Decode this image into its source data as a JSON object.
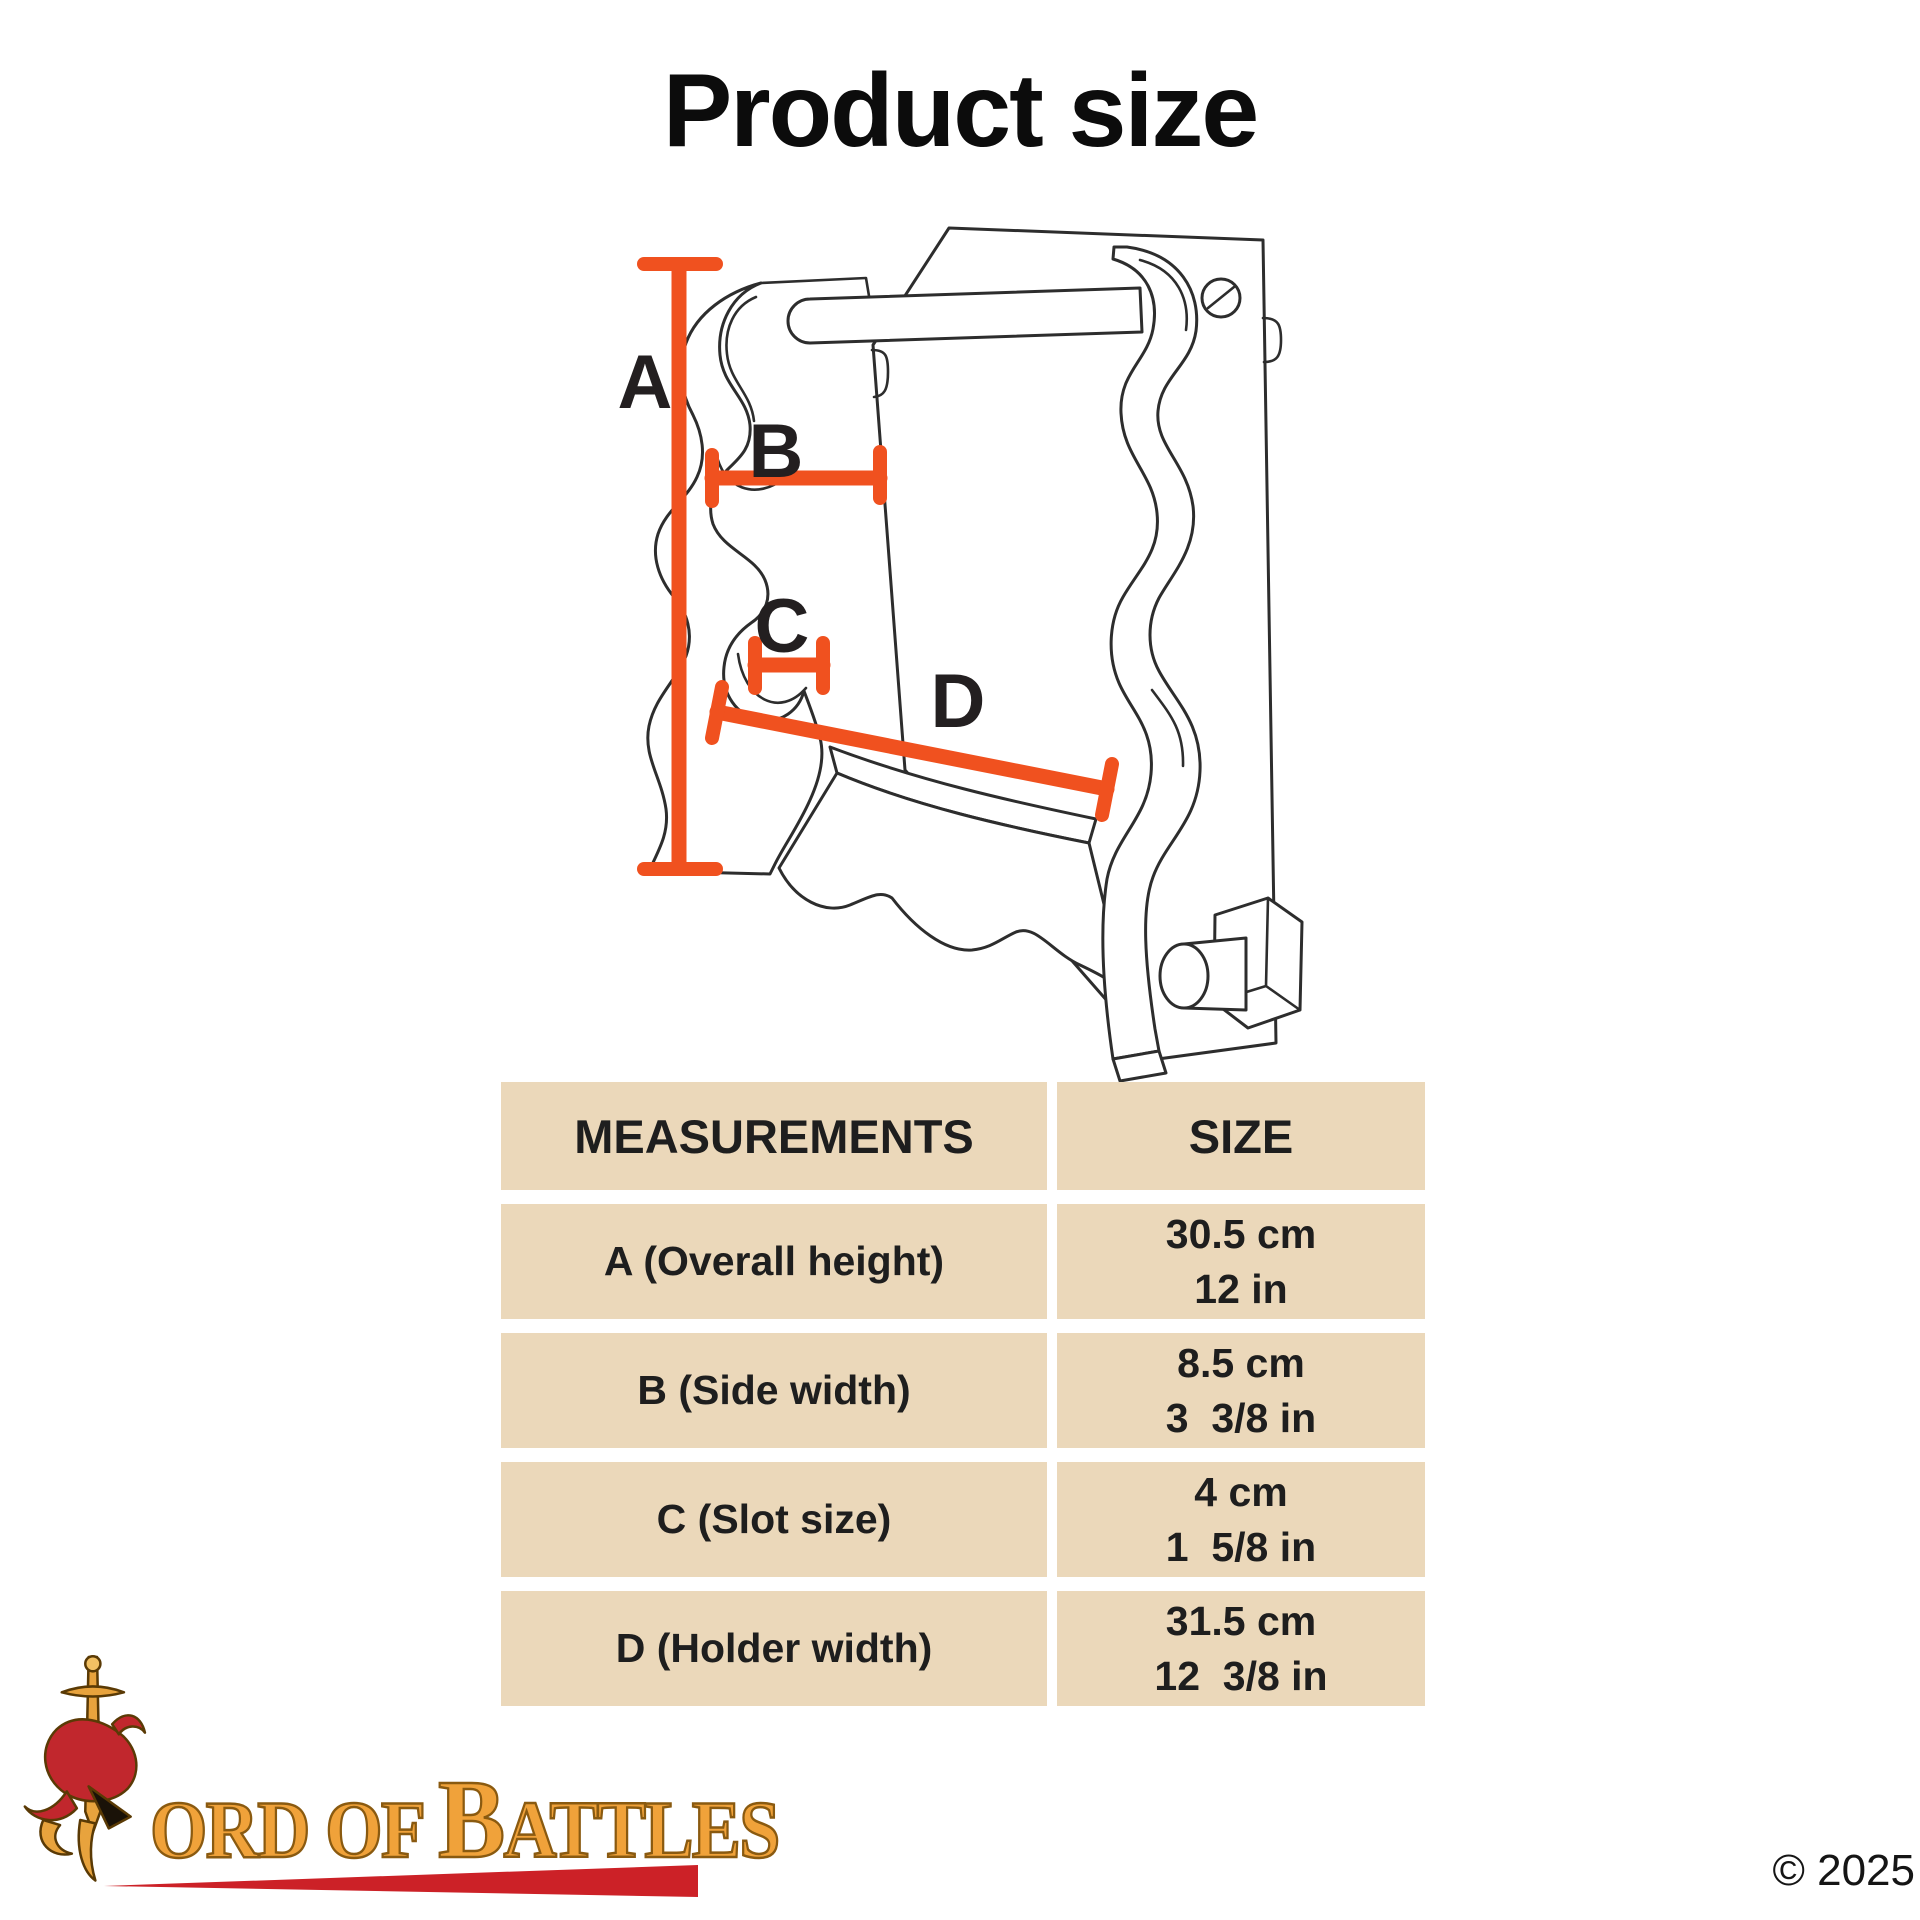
{
  "title": "Product size",
  "colors": {
    "accent": "#F0511F",
    "table-bg": "#EBD8BA",
    "ink": "#1e1e1e",
    "logo-gold": "#F0A23A",
    "logo-red": "#CC2127"
  },
  "diagram": {
    "labels": {
      "a": "A",
      "b": "B",
      "c": "C",
      "d": "D"
    },
    "drawing": "wall-mounted two-tier sword rack with S-scroll side brackets, top crossbar, back board with screw, scalloped base shelf and wall peg"
  },
  "table": {
    "headers": [
      "MEASUREMENTS",
      "SIZE"
    ],
    "rows": [
      {
        "label": "A (Overall height)",
        "size_metric": "30.5 cm",
        "size_imperial": "12 in"
      },
      {
        "label": "B (Side width)",
        "size_metric": "8.5 cm",
        "size_imperial": "3  3/8 in"
      },
      {
        "label": "C (Slot size)",
        "size_metric": "4 cm",
        "size_imperial": "1  5/8 in"
      },
      {
        "label": "D (Holder width)",
        "size_metric": "31.5 cm",
        "size_imperial": "12  3/8 in"
      }
    ]
  },
  "footer": {
    "logo_part1": "ord of ",
    "logo_part2": "B",
    "logo_part3": "attles",
    "copyright": "© 2025"
  }
}
